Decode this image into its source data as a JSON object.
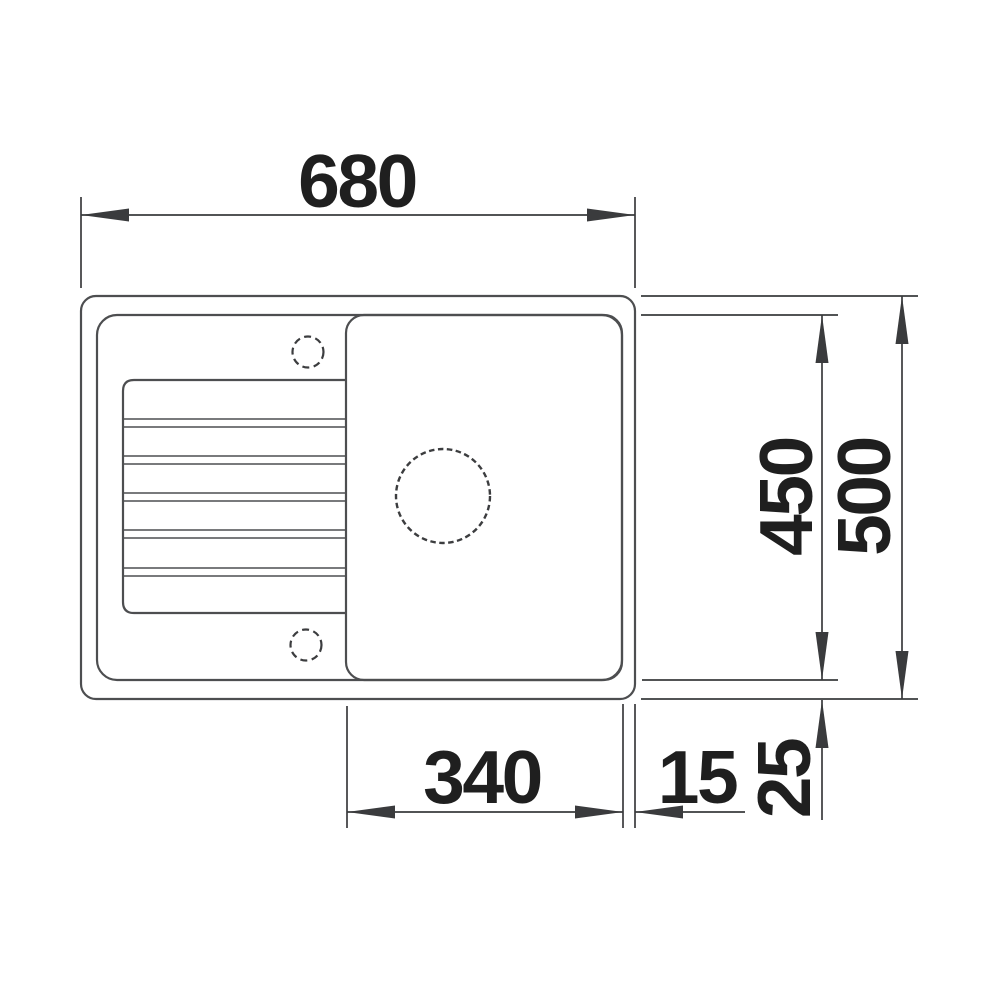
{
  "drawing": {
    "subject": "kitchen-sink-top-view-dimension-drawing",
    "units": "mm",
    "labels": {
      "overall_width": "680",
      "inner_depth": "450",
      "overall_depth": "500",
      "bowl_width": "340",
      "side_rim": "15",
      "bottom_rim": "25"
    },
    "colors": {
      "background": "#ffffff",
      "outline": "#4d4e50",
      "hole_outline": "#3c3d3f",
      "dimension": "#3a3b3d",
      "label_text": "#1f1f1f"
    }
  }
}
